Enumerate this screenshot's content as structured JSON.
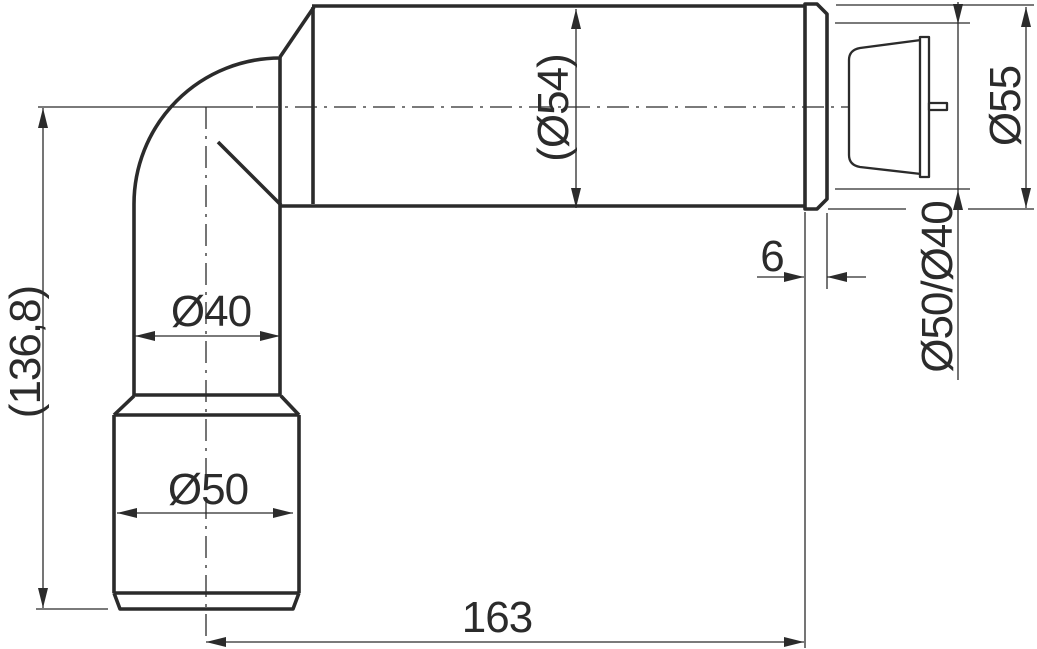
{
  "colors": {
    "line": "#2b2b2b",
    "background": "#ffffff"
  },
  "drawing": {
    "kind": "technical-dimension-drawing",
    "units": "mm",
    "labels": {
      "overall_height": "(136,8)",
      "pipe_diameter": "Ø40",
      "socket_diameter": "Ø50",
      "sleeve_diameter": "(Ø54)",
      "overall_length": "163",
      "collar_thickness": "6",
      "gasket_diameters": "Ø50/Ø40",
      "collar_diameter": "Ø55"
    }
  }
}
